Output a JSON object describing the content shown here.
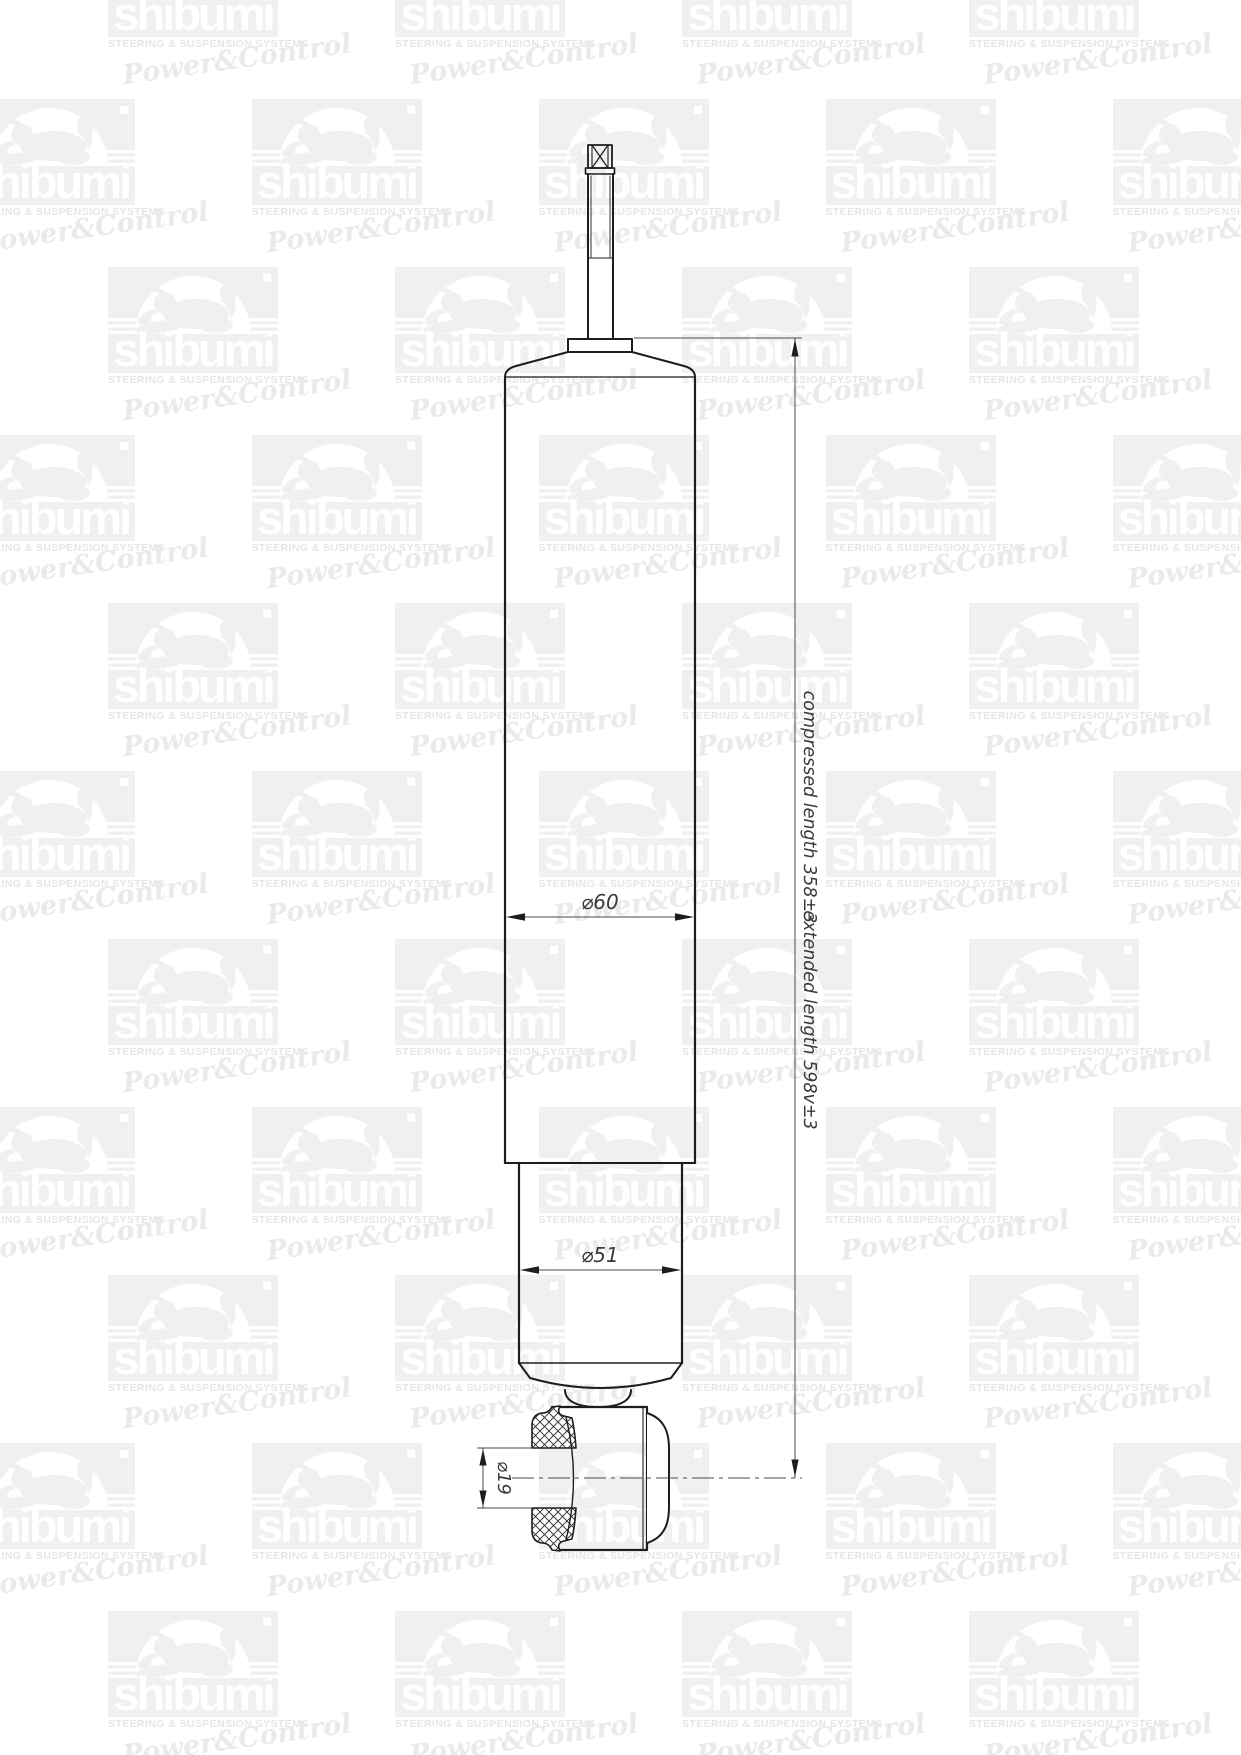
{
  "watermark": {
    "brand": "shibumi",
    "tagline": "STEERING & SUSPENSION SYSTEMS",
    "script": "Power&Control"
  },
  "drawing": {
    "dimensions": {
      "body_diameter": "⌀60",
      "lower_tube_diameter": "⌀51",
      "eye_bore_diameter": "⌀19",
      "compressed_length": "compressed length 358±3",
      "extended_length": "extended length 598v±3"
    }
  },
  "colors": {
    "page_bg": "#ffffff",
    "part_line": "#1d1d1d",
    "dim_line": "#4a4a4a",
    "watermark_gray": "#f0f0f0",
    "watermark_caption": "#e6e6e6"
  }
}
